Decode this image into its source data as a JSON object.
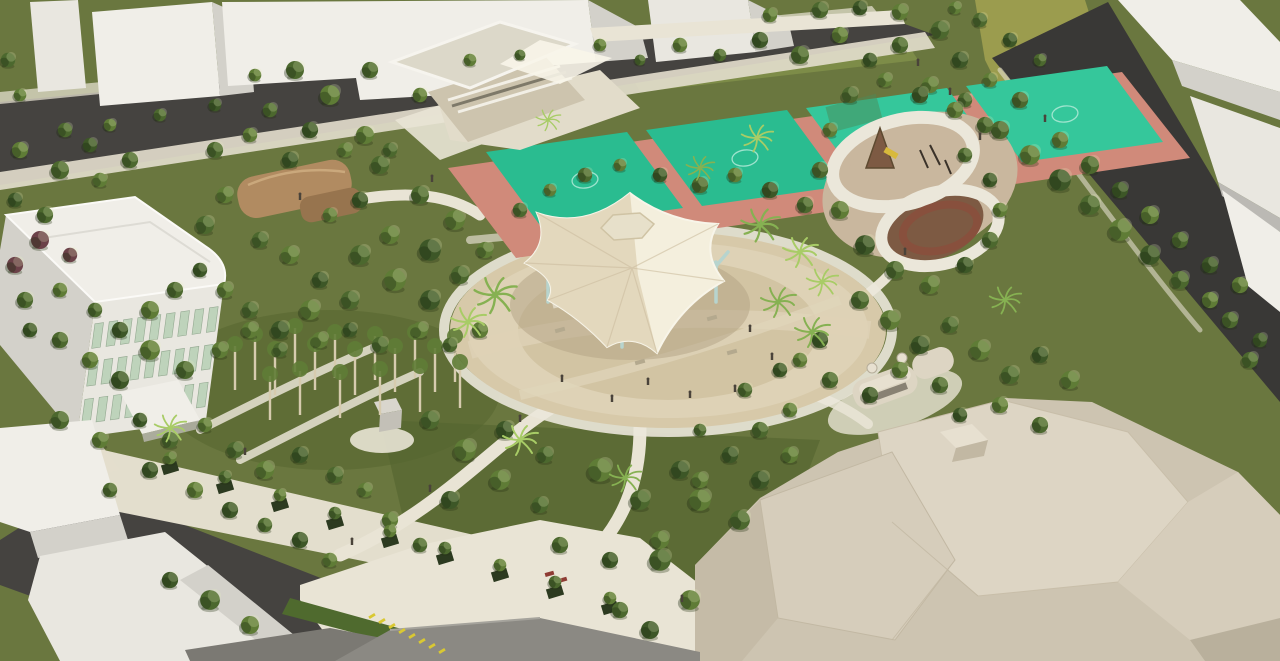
{
  "meta": {
    "type": "architectural-aerial-rendering",
    "subject": "park-master-plan-birds-eye-view"
  },
  "palette": {
    "grass_base": "#6a773f",
    "grass_light": "#7d8c48",
    "lawn_dark": "#55662f",
    "road": "#454340",
    "road_dark": "#393836",
    "sidewalk": "#e3decd",
    "path": "#e9e4d5",
    "plaza": "#d7c9a9",
    "plaza_light": "#ded2b6",
    "plaza_floor": "#d2c4a3",
    "plaza_shadow": "#b2a283",
    "canopy_light": "#f4efdd",
    "canopy_dark": "#ded0b2",
    "canopy_edge": "#f8f5e9",
    "crease": "#cbbd9e",
    "skylight": "#e7e0ca",
    "column": "#b7d4ce",
    "white_top": "#f0eee8",
    "white_front": "#e9e7e0",
    "white_side": "#d3d1ca",
    "white_dark": "#bbb9b4",
    "beige_wall": "#cdc4ae",
    "deck": "#e2dcca",
    "roof_slab": "#dcd8c9",
    "court_green": "#2abc90",
    "court_green2": "#35c79b",
    "court_border": "#d08a7a",
    "court_line": "#b2ead8",
    "house_roof": "#b18b61",
    "house_roof_dark": "#97744e",
    "play_sand": "#c9b79e",
    "play_brown": "#7d5a43",
    "ring": "#ebe7da",
    "seatwall": "#8a4f3c",
    "big_roof": "#ddd5c4",
    "big_roof2": "#d6cdbb",
    "big_base": "#cdc4b1",
    "big_shadow": "#c2b8a3",
    "big_dark": "#b9b09c",
    "kiosk": "#ddd5c3",
    "kiosk_roof": "#e7e0d0",
    "kiosk_band": "#5a5448",
    "olive": "#9b9c4e",
    "hedge": "#4f6a2e",
    "gray_roof": "#7b7973",
    "gray_roof2": "#8b8983",
    "monument": "#d9d6cd",
    "monument_side": "#c3c0b7",
    "bench": "#b4a98e",
    "bench_red": "#8e3b33",
    "fence_green": "#4c8a58",
    "window": "#bed3bb",
    "window_frame": "#93a890",
    "planter": "#2c3a20",
    "stage": "#ddd5c1",
    "trunk": "#d6cbae",
    "person": "#4a433a",
    "bike": "#d9c832",
    "palm_color": "#86b152",
    "palm_light": "#a8cc66",
    "tree_colors": [
      "#3d5727",
      "#4c682e",
      "#5f7c36",
      "#76934b",
      "#6b4148"
    ]
  },
  "scene": {
    "trees": [
      [
        8,
        60,
        0.8,
        1
      ],
      [
        20,
        95,
        0.7,
        2
      ],
      [
        65,
        130,
        0.8,
        1
      ],
      [
        110,
        125,
        0.7,
        2
      ],
      [
        160,
        115,
        0.7,
        1
      ],
      [
        215,
        105,
        0.7,
        0
      ],
      [
        295,
        70,
        1.0,
        1
      ],
      [
        330,
        95,
        1.1,
        2
      ],
      [
        370,
        70,
        0.9,
        1
      ],
      [
        420,
        95,
        0.8,
        2
      ],
      [
        310,
        130,
        0.9,
        0
      ],
      [
        365,
        135,
        1.0,
        2
      ],
      [
        270,
        110,
        0.8,
        1
      ],
      [
        255,
        75,
        0.7,
        2
      ],
      [
        470,
        60,
        0.7,
        2
      ],
      [
        520,
        55,
        0.6,
        1
      ],
      [
        600,
        45,
        0.7,
        2
      ],
      [
        640,
        60,
        0.6,
        1
      ],
      [
        680,
        45,
        0.8,
        2
      ],
      [
        720,
        55,
        0.7,
        1
      ],
      [
        760,
        40,
        0.9,
        0
      ],
      [
        800,
        55,
        1.0,
        1
      ],
      [
        840,
        35,
        0.9,
        2
      ],
      [
        870,
        60,
        0.8,
        0
      ],
      [
        900,
        45,
        0.9,
        1
      ],
      [
        770,
        15,
        0.8,
        2
      ],
      [
        820,
        10,
        0.9,
        1
      ],
      [
        860,
        8,
        0.8,
        0
      ],
      [
        900,
        12,
        0.9,
        2
      ],
      [
        940,
        30,
        1.0,
        1
      ],
      [
        960,
        60,
        0.9,
        0
      ],
      [
        930,
        85,
        0.9,
        2
      ],
      [
        965,
        100,
        0.8,
        1
      ],
      [
        980,
        20,
        0.8,
        1
      ],
      [
        955,
        8,
        0.7,
        2
      ],
      [
        20,
        150,
        0.9,
        2
      ],
      [
        60,
        170,
        1.0,
        1
      ],
      [
        15,
        200,
        0.8,
        0
      ],
      [
        45,
        215,
        0.9,
        1
      ],
      [
        40,
        240,
        1.0,
        4
      ],
      [
        15,
        265,
        0.9,
        4
      ],
      [
        70,
        255,
        0.8,
        4
      ],
      [
        100,
        180,
        0.8,
        2
      ],
      [
        130,
        160,
        0.9,
        1
      ],
      [
        90,
        145,
        0.8,
        0
      ],
      [
        25,
        300,
        0.9,
        1
      ],
      [
        60,
        290,
        0.8,
        2
      ],
      [
        215,
        150,
        0.9,
        1
      ],
      [
        250,
        135,
        0.8,
        2
      ],
      [
        290,
        160,
        0.9,
        0
      ],
      [
        345,
        150,
        0.8,
        2
      ],
      [
        380,
        165,
        1.0,
        1
      ],
      [
        225,
        195,
        0.9,
        2
      ],
      [
        205,
        225,
        1.0,
        1
      ],
      [
        360,
        200,
        0.9,
        0
      ],
      [
        330,
        215,
        0.8,
        2
      ],
      [
        390,
        150,
        0.8,
        1
      ],
      [
        420,
        195,
        1.0,
        1
      ],
      [
        455,
        220,
        1.1,
        2
      ],
      [
        430,
        250,
        1.2,
        0
      ],
      [
        390,
        235,
        1.0,
        2
      ],
      [
        360,
        255,
        1.1,
        1
      ],
      [
        395,
        280,
        1.2,
        2
      ],
      [
        430,
        300,
        1.1,
        0
      ],
      [
        460,
        275,
        1.0,
        1
      ],
      [
        485,
        250,
        0.9,
        2
      ],
      [
        350,
        300,
        1.0,
        1
      ],
      [
        320,
        280,
        0.9,
        0
      ],
      [
        290,
        255,
        1.0,
        2
      ],
      [
        260,
        240,
        0.9,
        1
      ],
      [
        310,
        310,
        1.1,
        2
      ],
      [
        280,
        330,
        1.0,
        0
      ],
      [
        250,
        310,
        0.9,
        1
      ],
      [
        225,
        290,
        0.9,
        2
      ],
      [
        200,
        270,
        0.8,
        0
      ],
      [
        175,
        290,
        0.9,
        1
      ],
      [
        150,
        310,
        1.0,
        2
      ],
      [
        120,
        330,
        0.9,
        0
      ],
      [
        95,
        310,
        0.8,
        1
      ],
      [
        150,
        350,
        1.1,
        2
      ],
      [
        185,
        370,
        1.0,
        1
      ],
      [
        120,
        380,
        1.0,
        0
      ],
      [
        90,
        360,
        0.9,
        2
      ],
      [
        60,
        340,
        0.9,
        1
      ],
      [
        30,
        330,
        0.8,
        0
      ],
      [
        220,
        350,
        0.9,
        2
      ],
      [
        250,
        330,
        0.9,
        2
      ],
      [
        280,
        350,
        0.8,
        1
      ],
      [
        320,
        340,
        0.9,
        2
      ],
      [
        350,
        330,
        0.8,
        0
      ],
      [
        380,
        345,
        0.9,
        1
      ],
      [
        420,
        330,
        0.9,
        2
      ],
      [
        450,
        345,
        0.8,
        1
      ],
      [
        480,
        330,
        0.9,
        2
      ],
      [
        60,
        420,
        1.0,
        1
      ],
      [
        100,
        440,
        0.9,
        2
      ],
      [
        140,
        420,
        0.8,
        0
      ],
      [
        170,
        440,
        0.9,
        1
      ],
      [
        205,
        425,
        0.8,
        2
      ],
      [
        235,
        450,
        0.9,
        1
      ],
      [
        265,
        470,
        1.0,
        2
      ],
      [
        300,
        455,
        0.9,
        0
      ],
      [
        335,
        475,
        0.9,
        1
      ],
      [
        365,
        490,
        0.8,
        2
      ],
      [
        150,
        470,
        0.9,
        0
      ],
      [
        110,
        490,
        0.8,
        1
      ],
      [
        195,
        490,
        0.9,
        2
      ],
      [
        230,
        510,
        0.9,
        0
      ],
      [
        265,
        525,
        0.8,
        1
      ],
      [
        390,
        520,
        0.9,
        2
      ],
      [
        420,
        545,
        0.8,
        1
      ],
      [
        300,
        540,
        0.9,
        0
      ],
      [
        330,
        560,
        0.8,
        2
      ],
      [
        170,
        458,
        0.7,
        2
      ],
      [
        225,
        477,
        0.7,
        1
      ],
      [
        280,
        495,
        0.7,
        2
      ],
      [
        335,
        513,
        0.7,
        1
      ],
      [
        390,
        531,
        0.7,
        2
      ],
      [
        445,
        548,
        0.7,
        1
      ],
      [
        500,
        565,
        0.7,
        2
      ],
      [
        555,
        582,
        0.7,
        1
      ],
      [
        610,
        598,
        0.7,
        2
      ],
      [
        430,
        420,
        1.0,
        1
      ],
      [
        465,
        450,
        1.2,
        2
      ],
      [
        505,
        430,
        1.0,
        0
      ],
      [
        545,
        455,
        0.9,
        1
      ],
      [
        500,
        480,
        1.1,
        2
      ],
      [
        450,
        500,
        1.0,
        0
      ],
      [
        540,
        505,
        0.9,
        1
      ],
      [
        600,
        470,
        1.3,
        2
      ],
      [
        640,
        500,
        1.1,
        1
      ],
      [
        680,
        470,
        1.0,
        0
      ],
      [
        700,
        500,
        1.2,
        2
      ],
      [
        740,
        520,
        1.1,
        1
      ],
      [
        660,
        540,
        1.0,
        2
      ],
      [
        610,
        560,
        0.9,
        0
      ],
      [
        560,
        545,
        0.9,
        1
      ],
      [
        760,
        480,
        1.0,
        0
      ],
      [
        790,
        455,
        0.9,
        2
      ],
      [
        700,
        430,
        0.7,
        1
      ],
      [
        660,
        560,
        1.2,
        1
      ],
      [
        690,
        600,
        1.1,
        2
      ],
      [
        650,
        630,
        1.0,
        0
      ],
      [
        620,
        610,
        0.9,
        1
      ],
      [
        860,
        300,
        1.0,
        1
      ],
      [
        890,
        320,
        1.1,
        2
      ],
      [
        920,
        345,
        1.0,
        0
      ],
      [
        950,
        325,
        0.9,
        1
      ],
      [
        980,
        350,
        1.1,
        2
      ],
      [
        1010,
        375,
        1.0,
        1
      ],
      [
        1040,
        355,
        0.9,
        0
      ],
      [
        1070,
        380,
        1.0,
        2
      ],
      [
        940,
        385,
        0.9,
        1
      ],
      [
        900,
        370,
        0.9,
        2
      ],
      [
        870,
        395,
        0.9,
        0
      ],
      [
        830,
        380,
        0.9,
        1
      ],
      [
        800,
        360,
        0.8,
        2
      ],
      [
        820,
        340,
        0.9,
        0
      ],
      [
        1000,
        405,
        0.9,
        2
      ],
      [
        1040,
        425,
        0.9,
        1
      ],
      [
        960,
        415,
        0.8,
        0
      ],
      [
        745,
        390,
        0.8,
        1
      ],
      [
        780,
        370,
        0.8,
        0
      ],
      [
        760,
        430,
        0.9,
        1
      ],
      [
        790,
        410,
        0.8,
        2
      ],
      [
        730,
        455,
        0.9,
        0
      ],
      [
        700,
        480,
        0.9,
        2
      ],
      [
        1000,
        130,
        1.0,
        1
      ],
      [
        1030,
        155,
        1.1,
        2
      ],
      [
        1060,
        180,
        1.2,
        0
      ],
      [
        1090,
        205,
        1.1,
        1
      ],
      [
        1120,
        230,
        1.2,
        2
      ],
      [
        1150,
        255,
        1.1,
        0
      ],
      [
        1180,
        280,
        1.0,
        1
      ],
      [
        1210,
        300,
        0.9,
        2
      ],
      [
        1060,
        140,
        0.9,
        2
      ],
      [
        1090,
        165,
        1.0,
        1
      ],
      [
        1120,
        190,
        0.9,
        0
      ],
      [
        1150,
        215,
        1.0,
        2
      ],
      [
        1180,
        240,
        0.9,
        1
      ],
      [
        1210,
        265,
        0.9,
        0
      ],
      [
        1240,
        285,
        0.9,
        2
      ],
      [
        1230,
        320,
        0.9,
        1
      ],
      [
        1260,
        340,
        0.8,
        0
      ],
      [
        1020,
        100,
        0.9,
        1
      ],
      [
        990,
        80,
        0.8,
        2
      ],
      [
        1040,
        60,
        0.7,
        1
      ],
      [
        1010,
        40,
        0.8,
        0
      ],
      [
        1250,
        360,
        0.9,
        1
      ],
      [
        850,
        95,
        0.9,
        1
      ],
      [
        885,
        80,
        0.8,
        2
      ],
      [
        920,
        95,
        0.9,
        0
      ],
      [
        955,
        110,
        0.9,
        2
      ],
      [
        985,
        125,
        0.9,
        1
      ],
      [
        830,
        130,
        0.8,
        2
      ],
      [
        820,
        170,
        0.9,
        1
      ],
      [
        840,
        210,
        1.0,
        2
      ],
      [
        865,
        245,
        1.1,
        0
      ],
      [
        895,
        270,
        1.0,
        1
      ],
      [
        930,
        285,
        1.0,
        2
      ],
      [
        965,
        265,
        0.9,
        0
      ],
      [
        990,
        240,
        0.9,
        1
      ],
      [
        1000,
        210,
        0.8,
        2
      ],
      [
        990,
        180,
        0.8,
        0
      ],
      [
        965,
        155,
        0.8,
        1
      ],
      [
        585,
        175,
        0.8,
        1
      ],
      [
        620,
        165,
        0.7,
        2
      ],
      [
        660,
        175,
        0.8,
        0
      ],
      [
        700,
        185,
        0.9,
        1
      ],
      [
        735,
        175,
        0.8,
        2
      ],
      [
        770,
        190,
        0.9,
        0
      ],
      [
        805,
        205,
        0.9,
        1
      ],
      [
        550,
        190,
        0.7,
        2
      ],
      [
        520,
        210,
        0.8,
        1
      ],
      [
        210,
        600,
        1.1,
        1
      ],
      [
        250,
        625,
        1.0,
        2
      ],
      [
        170,
        580,
        0.9,
        0
      ]
    ],
    "palms": [
      [
        495,
        295,
        1.2
      ],
      [
        468,
        322,
        1.0
      ],
      [
        760,
        225,
        1.1
      ],
      [
        800,
        252,
        1.0
      ],
      [
        778,
        302,
        1.0
      ],
      [
        822,
        282,
        0.9
      ],
      [
        700,
        168,
        0.8
      ],
      [
        757,
        138,
        0.9
      ],
      [
        1005,
        300,
        0.9
      ],
      [
        520,
        440,
        1.0
      ],
      [
        625,
        478,
        0.9
      ],
      [
        170,
        428,
        0.9
      ],
      [
        812,
        332,
        1.0
      ],
      [
        548,
        120,
        0.7
      ]
    ],
    "trunks": [
      [
        235,
        390
      ],
      [
        255,
        380
      ],
      [
        275,
        395
      ],
      [
        295,
        372
      ],
      [
        315,
        390
      ],
      [
        335,
        378
      ],
      [
        355,
        395
      ],
      [
        375,
        380
      ],
      [
        395,
        392
      ],
      [
        415,
        378
      ],
      [
        435,
        392
      ],
      [
        455,
        382
      ],
      [
        300,
        415
      ],
      [
        340,
        418
      ],
      [
        380,
        415
      ],
      [
        420,
        412
      ],
      [
        460,
        408
      ],
      [
        270,
        420
      ]
    ],
    "planters": [
      [
        170,
        468
      ],
      [
        225,
        487
      ],
      [
        280,
        505
      ],
      [
        335,
        523
      ],
      [
        390,
        541
      ],
      [
        445,
        558
      ],
      [
        500,
        575
      ],
      [
        555,
        592
      ],
      [
        610,
        608
      ]
    ],
    "benches": [
      [
        588,
        300
      ],
      [
        712,
        318
      ],
      [
        640,
        362
      ],
      [
        732,
        352
      ],
      [
        560,
        330
      ]
    ],
    "people": [
      [
        750,
        332
      ],
      [
        772,
        360
      ],
      [
        735,
        392
      ],
      [
        690,
        398
      ],
      [
        612,
        402
      ],
      [
        562,
        382
      ],
      [
        648,
        385
      ],
      [
        905,
        255
      ],
      [
        1045,
        122
      ],
      [
        950,
        95
      ],
      [
        352,
        545
      ],
      [
        430,
        492
      ],
      [
        245,
        455
      ],
      [
        520,
        422
      ],
      [
        682,
        602
      ],
      [
        918,
        66
      ],
      [
        980,
        140
      ],
      [
        300,
        200
      ],
      [
        432,
        182
      ]
    ],
    "bikes": [
      [
        372,
        616
      ],
      [
        382,
        621
      ],
      [
        392,
        626
      ],
      [
        402,
        631
      ],
      [
        412,
        636
      ],
      [
        422,
        641
      ],
      [
        432,
        646
      ],
      [
        442,
        651
      ]
    ],
    "facade_windows": {
      "rows": 3,
      "cols": 9
    }
  }
}
